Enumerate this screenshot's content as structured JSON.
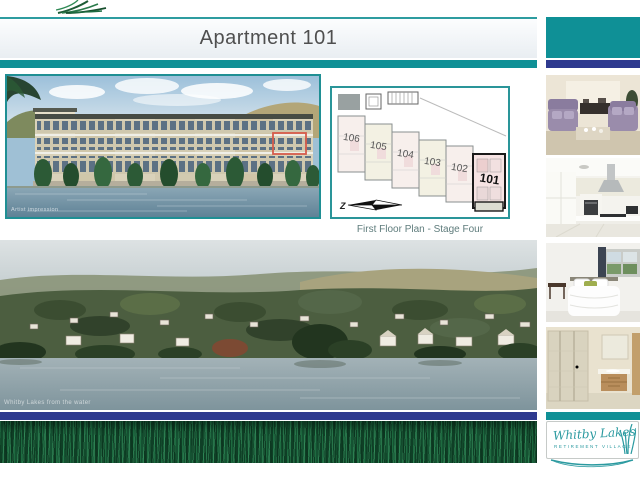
{
  "page": {
    "title": "Apartment 101"
  },
  "floor_plan": {
    "caption": "First Floor Plan - Stage Four",
    "compass_label": "Z",
    "unit_labels": [
      "106",
      "105",
      "104",
      "103",
      "102",
      "101"
    ],
    "highlighted_unit": "101"
  },
  "building_image": {
    "watermark": "Artist impression"
  },
  "village_image": {
    "watermark": "Whitby Lakes from the water"
  },
  "logo": {
    "name": "Whitby Lakes",
    "tagline": "RETIREMENT VILLAGE"
  },
  "colors": {
    "teal": "#0f9096",
    "navy": "#2e3a8f",
    "highlight_red": "#d65c4b",
    "logo_teal": "#2b9aa0",
    "grass_green": "#145131"
  }
}
